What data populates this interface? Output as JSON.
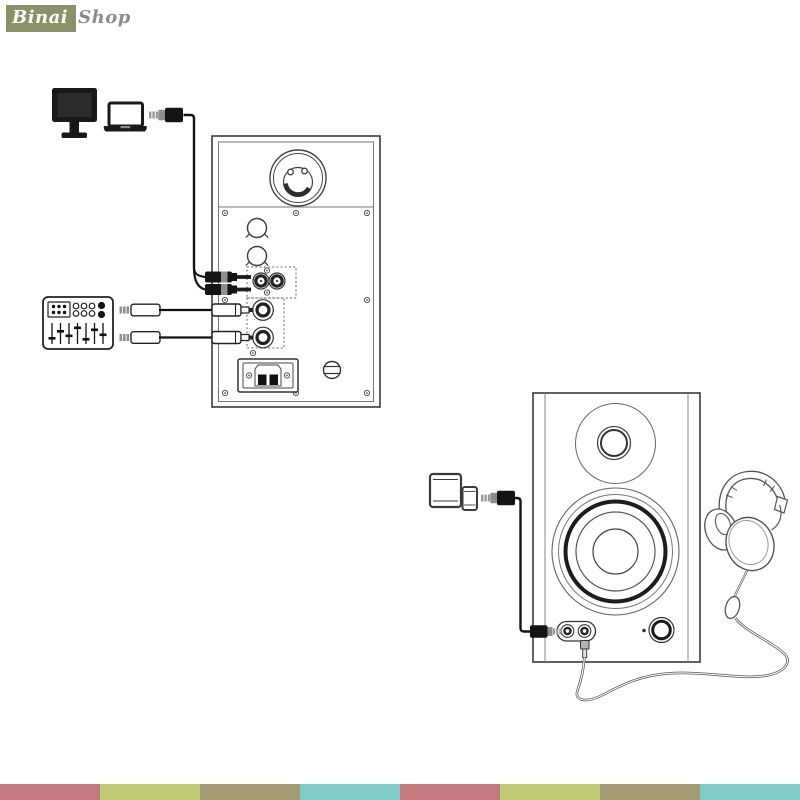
{
  "logo": {
    "brand_primary": "Binai",
    "brand_secondary": "Shop",
    "primary_bg": "#8a9166",
    "primary_color": "#ffffff",
    "secondary_color": "#8c8c85"
  },
  "diagram": {
    "top": {
      "source_icons": [
        "desktop-monitor-icon",
        "laptop-icon",
        "audio-mixer-icon"
      ],
      "target": "studio-monitor-rear-panel",
      "cables": [
        "aux-to-rca-y-cable",
        "trs-cable-upper",
        "trs-cable-lower"
      ],
      "rear_panel_parts": [
        "bass-reflex-port",
        "knob-1",
        "knob-2",
        "rca-input-pair",
        "trs-input-1",
        "trs-input-2",
        "power-inlet",
        "fuse-holder"
      ]
    },
    "bottom": {
      "source_icons": [
        "tablet-icon",
        "smartphone-icon"
      ],
      "target": "studio-monitor-front",
      "accessory_icons": [
        "headphones-icon",
        "inline-remote-icon"
      ],
      "cables": [
        "aux-cable",
        "headphone-cable"
      ],
      "front_parts": [
        "tweeter",
        "woofer",
        "aux-input-jack",
        "headphone-output-jack",
        "power-led",
        "volume-knob"
      ]
    },
    "line_color": "#3a3a3a",
    "fill_dark": "#141414",
    "metal_gray": "#8f8f8f"
  },
  "footer": {
    "stripe_colors": [
      "#c6797c",
      "#c2cb73",
      "#a49b72",
      "#7fcdc8",
      "#c6797c",
      "#c2cb73",
      "#a49b72",
      "#7fcdc8"
    ]
  }
}
